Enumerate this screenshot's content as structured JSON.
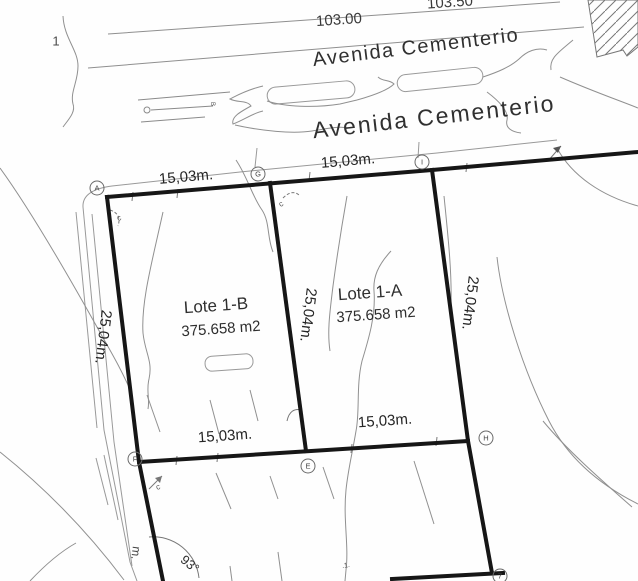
{
  "drawing": {
    "sheet_number": "1",
    "street": {
      "name_upper": "Avenida Cementerio",
      "name_lower": "Avenida Cementerio"
    },
    "elevations": {
      "line1": "103.00",
      "line2": "103.50"
    },
    "lots": [
      {
        "name": "Lote 1-B",
        "area": "375.658 m2"
      },
      {
        "name": "Lote 1-A",
        "area": "375.658 m2"
      }
    ],
    "dimensions": {
      "lot_b_front": "15,03m.",
      "lot_a_front": "15,03m.",
      "lot_b_back": "15,03m.",
      "lot_a_back": "15,03m.",
      "left_side": "25,04m.",
      "middle_side": "25,04m.",
      "right_side": "25,04m."
    },
    "angle_label": "93°",
    "vertices": [
      {
        "label": "A"
      },
      {
        "label": "G"
      },
      {
        "label": "I"
      },
      {
        "label": "F"
      },
      {
        "label": "E"
      },
      {
        "label": "H"
      },
      {
        "label": "7"
      }
    ],
    "annotations": {
      "curve1": "c",
      "curve2": "c",
      "curve3": "c",
      "benchmark": "B",
      "partial_dim": "m.",
      "dots": ".1."
    },
    "colors": {
      "boundary": "#161616",
      "contour": "#8f8f8f",
      "background": "#fefefe",
      "text": "#2e2e2e"
    }
  }
}
